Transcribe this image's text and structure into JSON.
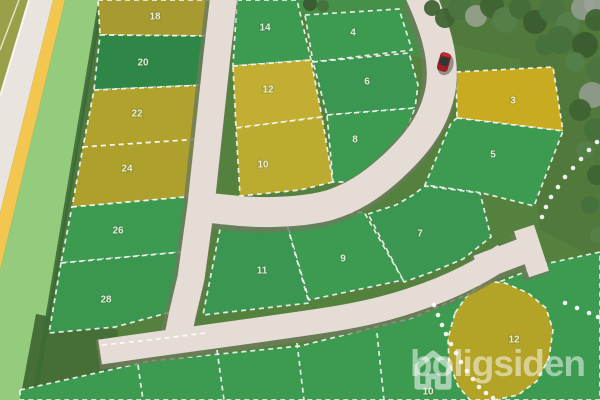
{
  "watermark": {
    "brand": "boligsiden",
    "icon": "house-icon"
  },
  "map": {
    "background": "#55813f",
    "colors": {
      "road": "#e6dcd6",
      "road_shadow": "#6d7a5c",
      "left_road": "#eae4df",
      "bike_stripe": "#f2c64f",
      "verge": "#95cb7d",
      "hedge": "#3c6a35",
      "rough": "#49743a",
      "dash": "#ffffff",
      "plot_green": "#3d9a51",
      "plot_dark_green": "#2e8746",
      "plot_olive": "#b1a12d",
      "plot_yellow": "#c2ae33",
      "plot_gold": "#c9ab22",
      "label": "#edf3e4",
      "car": "#a32222"
    },
    "bands": [
      {
        "name": "field-top-left",
        "fill": "#9aa04a",
        "points": [
          [
            0,
            0
          ],
          [
            30,
            0
          ],
          [
            0,
            97
          ]
        ]
      },
      {
        "name": "left-road",
        "fill": "#eae4df",
        "points": [
          [
            28,
            0
          ],
          [
            53,
            0
          ],
          [
            0,
            213
          ],
          [
            0,
            95
          ]
        ]
      },
      {
        "name": "bike-stripe",
        "fill": "#f2c64f",
        "points": [
          [
            53,
            0
          ],
          [
            65,
            0
          ],
          [
            0,
            270
          ],
          [
            0,
            213
          ]
        ]
      },
      {
        "name": "verge",
        "fill": "#95cb7d",
        "points": [
          [
            65,
            0
          ],
          [
            101,
            0
          ],
          [
            34,
            400
          ],
          [
            0,
            400
          ],
          [
            0,
            270
          ]
        ]
      },
      {
        "name": "rough-verge-edge",
        "fill": "#4e7a3e",
        "points": [
          [
            101,
            0
          ],
          [
            113,
            0
          ],
          [
            55,
            400
          ],
          [
            34,
            400
          ]
        ]
      },
      {
        "name": "rough-bottom-left",
        "fill": "#456f36",
        "points": [
          [
            36,
            314
          ],
          [
            118,
            330
          ],
          [
            112,
            400
          ],
          [
            20,
            400
          ]
        ]
      },
      {
        "name": "green-top-strip",
        "fill": "#47904a",
        "points": [
          [
            292,
            0
          ],
          [
            436,
            0
          ],
          [
            449,
            42
          ],
          [
            456,
            68
          ],
          [
            410,
            55
          ],
          [
            303,
            14
          ]
        ]
      }
    ],
    "under_lines": [
      {
        "name": "field-track-line",
        "points": [
          [
            19,
            0
          ],
          [
            0,
            50
          ]
        ],
        "stroke": "#ffffff",
        "w": 1.5,
        "op": 0.7
      },
      {
        "name": "left-road-curb",
        "points": [
          [
            29,
            0
          ],
          [
            0,
            96
          ]
        ],
        "stroke": "#ffffff",
        "w": 2,
        "op": 0.75
      },
      {
        "name": "hedge-line",
        "points": [
          [
            101,
            0
          ],
          [
            34,
            400
          ]
        ],
        "stroke": "#3c6a35",
        "w": 5,
        "op": 0.9
      }
    ],
    "plots": [
      {
        "id": "18",
        "label": "18",
        "fill": "#a79a30",
        "points": [
          [
            98,
            0
          ],
          [
            212,
            0
          ],
          [
            209,
            36
          ],
          [
            100,
            35
          ]
        ],
        "label_xy": [
          155,
          16
        ]
      },
      {
        "id": "20",
        "label": "20",
        "fill": "#2e8746",
        "points": [
          [
            100,
            35
          ],
          [
            209,
            36
          ],
          [
            205,
            85
          ],
          [
            94,
            90
          ]
        ],
        "label_xy": [
          143,
          62
        ]
      },
      {
        "id": "22",
        "label": "22",
        "fill": "#b1a12d",
        "points": [
          [
            94,
            90
          ],
          [
            205,
            85
          ],
          [
            201,
            139
          ],
          [
            83,
            147
          ]
        ],
        "label_xy": [
          137,
          113
        ]
      },
      {
        "id": "24",
        "label": "24",
        "fill": "#ada02c",
        "points": [
          [
            83,
            147
          ],
          [
            201,
            139
          ],
          [
            197,
            196
          ],
          [
            72,
            207
          ]
        ],
        "label_xy": [
          127,
          168
        ]
      },
      {
        "id": "26",
        "label": "26",
        "fill": "#3d9a51",
        "points": [
          [
            72,
            207
          ],
          [
            197,
            196
          ],
          [
            193,
            251
          ],
          [
            61,
            263
          ]
        ],
        "label_xy": [
          118,
          230
        ]
      },
      {
        "id": "28",
        "label": "28",
        "fill": "#3b9750",
        "points": [
          [
            61,
            263
          ],
          [
            193,
            251
          ],
          [
            186,
            308
          ],
          [
            115,
            327
          ],
          [
            49,
            333
          ]
        ],
        "label_xy": [
          106,
          299
        ]
      },
      {
        "id": "14",
        "label": "14",
        "fill": "#3d9a51",
        "points": [
          [
            237,
            0
          ],
          [
            297,
            0
          ],
          [
            311,
            60
          ],
          [
            233,
            66
          ]
        ],
        "label_xy": [
          265,
          27
        ]
      },
      {
        "id": "12",
        "label": "12",
        "fill": "#c2ae33",
        "points": [
          [
            233,
            66
          ],
          [
            311,
            60
          ],
          [
            322,
            117
          ],
          [
            236,
            128
          ]
        ],
        "label_xy": [
          268,
          89
        ]
      },
      {
        "id": "10",
        "label": "10",
        "fill": "#bcab31",
        "points": [
          [
            236,
            128
          ],
          [
            322,
            117
          ],
          [
            333,
            182
          ],
          [
            300,
            190
          ],
          [
            240,
            196
          ]
        ],
        "label_xy": [
          263,
          164
        ]
      },
      {
        "id": "4",
        "label": "4",
        "fill": "#3d9a51",
        "points": [
          [
            305,
            15
          ],
          [
            399,
            9
          ],
          [
            412,
            50
          ],
          [
            313,
            62
          ]
        ],
        "label_xy": [
          353,
          32
        ]
      },
      {
        "id": "6",
        "label": "6",
        "fill": "#3a9650",
        "points": [
          [
            313,
            62
          ],
          [
            409,
            53
          ],
          [
            418,
            85
          ],
          [
            415,
            108
          ],
          [
            327,
            115
          ]
        ],
        "label_xy": [
          367,
          81
        ]
      },
      {
        "id": "8",
        "label": "8",
        "fill": "#3d9a51",
        "points": [
          [
            327,
            115
          ],
          [
            415,
            108
          ],
          [
            406,
            132
          ],
          [
            385,
            160
          ],
          [
            357,
            182
          ],
          [
            333,
            182
          ]
        ],
        "label_xy": [
          355,
          139
        ]
      },
      {
        "id": "3",
        "label": "3",
        "fill": "#c9ab22",
        "points": [
          [
            456,
            72
          ],
          [
            553,
            67
          ],
          [
            563,
            131
          ],
          [
            457,
            118
          ]
        ],
        "label_xy": [
          513,
          100
        ]
      },
      {
        "id": "5",
        "label": "5",
        "fill": "#3d9a51",
        "points": [
          [
            457,
            118
          ],
          [
            563,
            131
          ],
          [
            534,
            206
          ],
          [
            482,
            193
          ],
          [
            425,
            185
          ],
          [
            451,
            123
          ]
        ],
        "label_xy": [
          493,
          154
        ]
      },
      {
        "id": "7",
        "label": "7",
        "fill": "#3a9650",
        "points": [
          [
            368,
            214
          ],
          [
            396,
            205
          ],
          [
            413,
            195
          ],
          [
            425,
            186
          ],
          [
            480,
            193
          ],
          [
            491,
            237
          ],
          [
            463,
            259
          ],
          [
            432,
            272
          ],
          [
            404,
            282
          ]
        ],
        "label_xy": [
          420,
          233
        ]
      },
      {
        "id": "9",
        "label": "9",
        "fill": "#3d9a51",
        "points": [
          [
            285,
            218
          ],
          [
            364,
            212
          ],
          [
            403,
            280
          ],
          [
            309,
            300
          ]
        ],
        "label_xy": [
          343,
          258
        ]
      },
      {
        "id": "11",
        "label": "11",
        "fill": "#3a9650",
        "points": [
          [
            221,
            224
          ],
          [
            285,
            218
          ],
          [
            309,
            303
          ],
          [
            203,
            315
          ]
        ],
        "label_xy": [
          262,
          270
        ]
      },
      {
        "id": "south-row",
        "label": null,
        "fill": "#3d9a51",
        "points": [
          [
            20,
            390
          ],
          [
            150,
            361
          ],
          [
            300,
            346
          ],
          [
            412,
            318
          ],
          [
            466,
            295
          ],
          [
            545,
            264
          ],
          [
            600,
            252
          ],
          [
            600,
            400
          ],
          [
            20,
            400
          ]
        ],
        "label_xy": null
      },
      {
        "id": "12b",
        "label": "12",
        "fill": "#b3a326",
        "points": [
          [
            455,
            313
          ],
          [
            466,
            297
          ],
          [
            485,
            281
          ],
          [
            505,
            283
          ],
          [
            528,
            293
          ],
          [
            546,
            308
          ],
          [
            553,
            330
          ],
          [
            549,
            358
          ],
          [
            537,
            381
          ],
          [
            518,
            395
          ],
          [
            495,
            400
          ],
          [
            470,
            400
          ],
          [
            458,
            386
          ],
          [
            449,
            362
          ],
          [
            448,
            338
          ]
        ],
        "label_xy": [
          514,
          339
        ]
      }
    ],
    "extra_labels": [
      {
        "text": "10",
        "x": 428,
        "y": 391
      }
    ],
    "roads": [
      {
        "name": "entrance-arc-road",
        "d": "M420,-6 C432,20 447,58 440,92 C433,125 414,147 391,168 C370,187 352,198 330,205 C305,212 262,214 230,210 L210,208",
        "w": 30
      },
      {
        "name": "main-vertical-road",
        "d": "M224,-6 L217,55 L209,130 L201,205 L191,278 L182,316 L177,342",
        "w": 27
      },
      {
        "name": "bottom-road",
        "d": "M100,352 C160,343 240,333 320,321 C368,314 402,305 440,290 C464,280 487,268 505,255",
        "w": 25
      },
      {
        "name": "hammerhead-stub",
        "d": "M478,268 L536,246",
        "w": 26
      },
      {
        "name": "hammerhead-bar",
        "d": "M524,228 L539,274",
        "w": 21
      }
    ],
    "over_dashes": [
      {
        "name": "row-divider-1",
        "points": [
          [
            138,
            365
          ],
          [
            143,
            400
          ]
        ]
      },
      {
        "name": "row-divider-2",
        "points": [
          [
            217,
            350
          ],
          [
            224,
            400
          ]
        ]
      },
      {
        "name": "row-divider-3",
        "points": [
          [
            297,
            343
          ],
          [
            304,
            400
          ]
        ]
      },
      {
        "name": "row-divider-4",
        "points": [
          [
            377,
            333
          ],
          [
            384,
            400
          ]
        ]
      },
      {
        "name": "road-north-dash",
        "points": [
          [
            102,
            345
          ],
          [
            150,
            340
          ],
          [
            205,
            333
          ]
        ]
      }
    ],
    "tree_dot_rows": [
      {
        "name": "tree-dots-right",
        "dots": [
          [
            597,
            142
          ],
          [
            589,
            150
          ],
          [
            581,
            159
          ],
          [
            573,
            168
          ],
          [
            565,
            177
          ],
          [
            558,
            187
          ],
          [
            551,
            197
          ],
          [
            546,
            207
          ],
          [
            542,
            217
          ]
        ]
      },
      {
        "name": "tree-dots-corner",
        "dots": [
          [
            565,
            303
          ],
          [
            577,
            308
          ],
          [
            589,
            313
          ],
          [
            598,
            317
          ]
        ]
      },
      {
        "name": "tree-dots-plot12",
        "dots": [
          [
            434,
            305
          ],
          [
            438,
            315
          ],
          [
            442,
            325
          ],
          [
            446,
            334
          ],
          [
            451,
            344
          ],
          [
            456,
            353
          ],
          [
            461,
            362
          ],
          [
            467,
            371
          ],
          [
            473,
            379
          ],
          [
            479,
            387
          ],
          [
            486,
            393
          ],
          [
            493,
            398
          ]
        ]
      }
    ],
    "trees": [
      {
        "x": 445,
        "y": 18,
        "r": 10,
        "c": "#3f6433"
      },
      {
        "x": 460,
        "y": 8,
        "r": 12,
        "c": "#4a7540"
      },
      {
        "x": 476,
        "y": 16,
        "r": 11,
        "c": "#92a089"
      },
      {
        "x": 492,
        "y": 6,
        "r": 12,
        "c": "#3f6433"
      },
      {
        "x": 505,
        "y": 20,
        "r": 13,
        "c": "#54804a"
      },
      {
        "x": 520,
        "y": 8,
        "r": 11,
        "c": "#436d39"
      },
      {
        "x": 535,
        "y": 22,
        "r": 12,
        "c": "#3a5c2f"
      },
      {
        "x": 552,
        "y": 10,
        "r": 13,
        "c": "#4a7540"
      },
      {
        "x": 568,
        "y": 24,
        "r": 12,
        "c": "#54804a"
      },
      {
        "x": 583,
        "y": 8,
        "r": 12,
        "c": "#8f9b8a"
      },
      {
        "x": 596,
        "y": 4,
        "r": 12,
        "c": "#9aa296"
      },
      {
        "x": 596,
        "y": 20,
        "r": 11,
        "c": "#3f6433"
      },
      {
        "x": 560,
        "y": 40,
        "r": 14,
        "c": "#46713c"
      },
      {
        "x": 585,
        "y": 45,
        "r": 13,
        "c": "#3a5c2f"
      },
      {
        "x": 545,
        "y": 45,
        "r": 10,
        "c": "#46713c"
      },
      {
        "x": 575,
        "y": 62,
        "r": 10,
        "c": "#54804a"
      },
      {
        "x": 598,
        "y": 70,
        "r": 12,
        "c": "#4a7540"
      },
      {
        "x": 592,
        "y": 95,
        "r": 13,
        "c": "#8f9b8a"
      },
      {
        "x": 580,
        "y": 110,
        "r": 11,
        "c": "#3f6433"
      },
      {
        "x": 596,
        "y": 130,
        "r": 12,
        "c": "#46713c"
      },
      {
        "x": 585,
        "y": 150,
        "r": 9,
        "c": "#54804a"
      },
      {
        "x": 597,
        "y": 175,
        "r": 10,
        "c": "#3f6433"
      },
      {
        "x": 590,
        "y": 205,
        "r": 9,
        "c": "#46713c"
      },
      {
        "x": 598,
        "y": 235,
        "r": 8,
        "c": "#54804a"
      },
      {
        "x": 432,
        "y": 8,
        "r": 8,
        "c": "#3f6433"
      },
      {
        "x": 310,
        "y": 4,
        "r": 7,
        "c": "#3a5c2f"
      },
      {
        "x": 323,
        "y": 6,
        "r": 6,
        "c": "#46713c"
      }
    ],
    "car": {
      "x": 444,
      "y": 62,
      "angle": 15,
      "body": "#9b2020",
      "roof": "#32353a",
      "nose": "#c03030"
    }
  }
}
